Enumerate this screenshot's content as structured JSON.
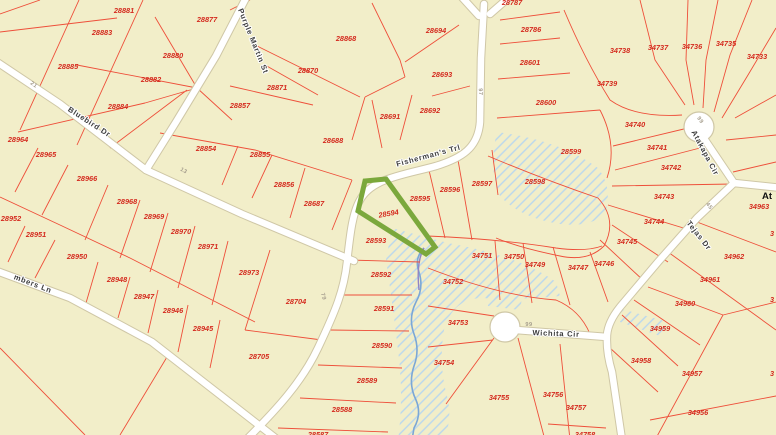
{
  "map": {
    "background_color": "#f2eec9",
    "parcel_line_color": "#ee4f3a",
    "parcel_label_color": "#d42a1e",
    "road_fill_color": "#ffffff",
    "road_casing_color": "#cfc7a6",
    "street_label_color": "#3d3d3d",
    "highlight_color": "#7ba83c",
    "creek_color": "#7ba7d6",
    "creek_upper_color": "#9184c4",
    "flood_hatch_color": "#b9d7ee",
    "highlighted_parcel": "28594",
    "streets": [
      {
        "name": "Purple Martin St",
        "x": 251,
        "y": 42,
        "rotate": 68
      },
      {
        "name": "Bluebird Dr",
        "x": 88,
        "y": 124,
        "rotate": 33
      },
      {
        "name": "Fisherman's Trl",
        "x": 429,
        "y": 158,
        "rotate": -15
      },
      {
        "name": "mbers Ln",
        "x": 32,
        "y": 286,
        "rotate": 21
      },
      {
        "name": "Atakapa Cir",
        "x": 703,
        "y": 154,
        "rotate": 62
      },
      {
        "name": "Tejas Dr",
        "x": 697,
        "y": 237,
        "rotate": 52
      },
      {
        "name": "Wichita Cir",
        "x": 556,
        "y": 336,
        "rotate": 2
      }
    ],
    "road_numbers": [
      {
        "text": "21",
        "x": 33,
        "y": 86,
        "rotate": 35
      },
      {
        "text": "13",
        "x": 183,
        "y": 172,
        "rotate": 30
      },
      {
        "text": "97",
        "x": 479,
        "y": 92,
        "rotate": 87
      },
      {
        "text": "79",
        "x": 322,
        "y": 297,
        "rotate": 75
      },
      {
        "text": "99",
        "x": 699,
        "y": 121,
        "rotate": 55
      },
      {
        "text": "45",
        "x": 708,
        "y": 207,
        "rotate": 52
      },
      {
        "text": "99",
        "x": 529,
        "y": 326,
        "rotate": 0
      }
    ],
    "parcels": [
      {
        "id": "28881",
        "x": 124,
        "y": 13
      },
      {
        "id": "28877",
        "x": 207,
        "y": 22
      },
      {
        "id": "28883",
        "x": 102,
        "y": 35
      },
      {
        "id": "28880",
        "x": 173,
        "y": 58
      },
      {
        "id": "28885",
        "x": 68,
        "y": 69
      },
      {
        "id": "28882",
        "x": 151,
        "y": 82
      },
      {
        "id": "28884",
        "x": 118,
        "y": 109
      },
      {
        "id": "28857",
        "x": 240,
        "y": 108
      },
      {
        "id": "28868",
        "x": 346,
        "y": 41
      },
      {
        "id": "28870",
        "x": 308,
        "y": 73
      },
      {
        "id": "28871",
        "x": 277,
        "y": 90
      },
      {
        "id": "28694",
        "x": 436,
        "y": 33
      },
      {
        "id": "28693",
        "x": 442,
        "y": 77
      },
      {
        "id": "28692",
        "x": 430,
        "y": 113
      },
      {
        "id": "28691",
        "x": 390,
        "y": 119
      },
      {
        "id": "28688",
        "x": 333,
        "y": 143
      },
      {
        "id": "28854",
        "x": 206,
        "y": 151
      },
      {
        "id": "28855",
        "x": 260,
        "y": 157
      },
      {
        "id": "28856",
        "x": 284,
        "y": 187
      },
      {
        "id": "28687",
        "x": 314,
        "y": 206
      },
      {
        "id": "28787",
        "x": 512,
        "y": 5
      },
      {
        "id": "28786",
        "x": 531,
        "y": 32
      },
      {
        "id": "28601",
        "x": 530,
        "y": 65
      },
      {
        "id": "28600",
        "x": 546,
        "y": 105
      },
      {
        "id": "28599",
        "x": 571,
        "y": 154
      },
      {
        "id": "28598",
        "x": 535,
        "y": 184
      },
      {
        "id": "34738",
        "x": 620,
        "y": 53
      },
      {
        "id": "34737",
        "x": 658,
        "y": 50
      },
      {
        "id": "34736",
        "x": 692,
        "y": 49
      },
      {
        "id": "34735",
        "x": 726,
        "y": 46
      },
      {
        "id": "34733",
        "x": 757,
        "y": 59
      },
      {
        "id": "34739",
        "x": 607,
        "y": 86
      },
      {
        "id": "34740",
        "x": 635,
        "y": 127
      },
      {
        "id": "34741",
        "x": 657,
        "y": 150
      },
      {
        "id": "34742",
        "x": 671,
        "y": 170
      },
      {
        "id": "34743",
        "x": 664,
        "y": 199
      },
      {
        "id": "34744",
        "x": 654,
        "y": 224
      },
      {
        "id": "34745",
        "x": 627,
        "y": 244
      },
      {
        "id": "34746",
        "x": 604,
        "y": 266
      },
      {
        "id": "34747",
        "x": 578,
        "y": 270
      },
      {
        "id": "34749",
        "x": 535,
        "y": 267
      },
      {
        "id": "34750",
        "x": 514,
        "y": 259
      },
      {
        "id": "34751",
        "x": 482,
        "y": 258
      },
      {
        "id": "34752",
        "x": 453,
        "y": 284
      },
      {
        "id": "34753",
        "x": 458,
        "y": 325
      },
      {
        "id": "34754",
        "x": 444,
        "y": 365
      },
      {
        "id": "34755",
        "x": 499,
        "y": 400
      },
      {
        "id": "34756",
        "x": 553,
        "y": 397
      },
      {
        "id": "34757",
        "x": 576,
        "y": 410
      },
      {
        "id": "34758",
        "x": 585,
        "y": 437
      },
      {
        "id": "34963",
        "x": 759,
        "y": 209
      },
      {
        "id": "34962",
        "x": 734,
        "y": 259
      },
      {
        "id": "34961",
        "x": 710,
        "y": 282
      },
      {
        "id": "34960",
        "x": 685,
        "y": 306
      },
      {
        "id": "34959",
        "x": 660,
        "y": 331
      },
      {
        "id": "34958",
        "x": 641,
        "y": 363
      },
      {
        "id": "34957",
        "x": 692,
        "y": 376
      },
      {
        "id": "34956",
        "x": 698,
        "y": 415
      },
      {
        "id": "28964",
        "x": 18,
        "y": 142
      },
      {
        "id": "28965",
        "x": 46,
        "y": 157
      },
      {
        "id": "28966",
        "x": 87,
        "y": 181
      },
      {
        "id": "28968",
        "x": 127,
        "y": 204
      },
      {
        "id": "28969",
        "x": 154,
        "y": 219
      },
      {
        "id": "28970",
        "x": 181,
        "y": 234
      },
      {
        "id": "28971",
        "x": 208,
        "y": 249
      },
      {
        "id": "28973",
        "x": 249,
        "y": 275
      },
      {
        "id": "28952",
        "x": 11,
        "y": 221
      },
      {
        "id": "28951",
        "x": 36,
        "y": 237
      },
      {
        "id": "28950",
        "x": 77,
        "y": 259
      },
      {
        "id": "28948",
        "x": 117,
        "y": 282
      },
      {
        "id": "28947",
        "x": 144,
        "y": 299
      },
      {
        "id": "28946",
        "x": 173,
        "y": 313
      },
      {
        "id": "28945",
        "x": 203,
        "y": 331
      },
      {
        "id": "28704",
        "x": 296,
        "y": 304
      },
      {
        "id": "28705",
        "x": 259,
        "y": 359
      },
      {
        "id": "28594",
        "x": 389,
        "y": 216,
        "rotate": -10
      },
      {
        "id": "28595",
        "x": 420,
        "y": 201
      },
      {
        "id": "28596",
        "x": 450,
        "y": 192
      },
      {
        "id": "28597",
        "x": 482,
        "y": 186
      },
      {
        "id": "28593",
        "x": 376,
        "y": 243
      },
      {
        "id": "28592",
        "x": 381,
        "y": 277
      },
      {
        "id": "28591",
        "x": 384,
        "y": 311
      },
      {
        "id": "28590",
        "x": 382,
        "y": 348
      },
      {
        "id": "28589",
        "x": 367,
        "y": 383
      },
      {
        "id": "28588",
        "x": 342,
        "y": 412
      },
      {
        "id": "28587",
        "x": 318,
        "y": 437
      }
    ],
    "edge_partials": [
      {
        "text": "3",
        "x": 770,
        "y": 236
      },
      {
        "text": "3",
        "x": 770,
        "y": 302
      },
      {
        "text": "3",
        "x": 770,
        "y": 376
      }
    ],
    "area_labels": [
      {
        "text": "At",
        "x": 762,
        "y": 199
      }
    ]
  }
}
